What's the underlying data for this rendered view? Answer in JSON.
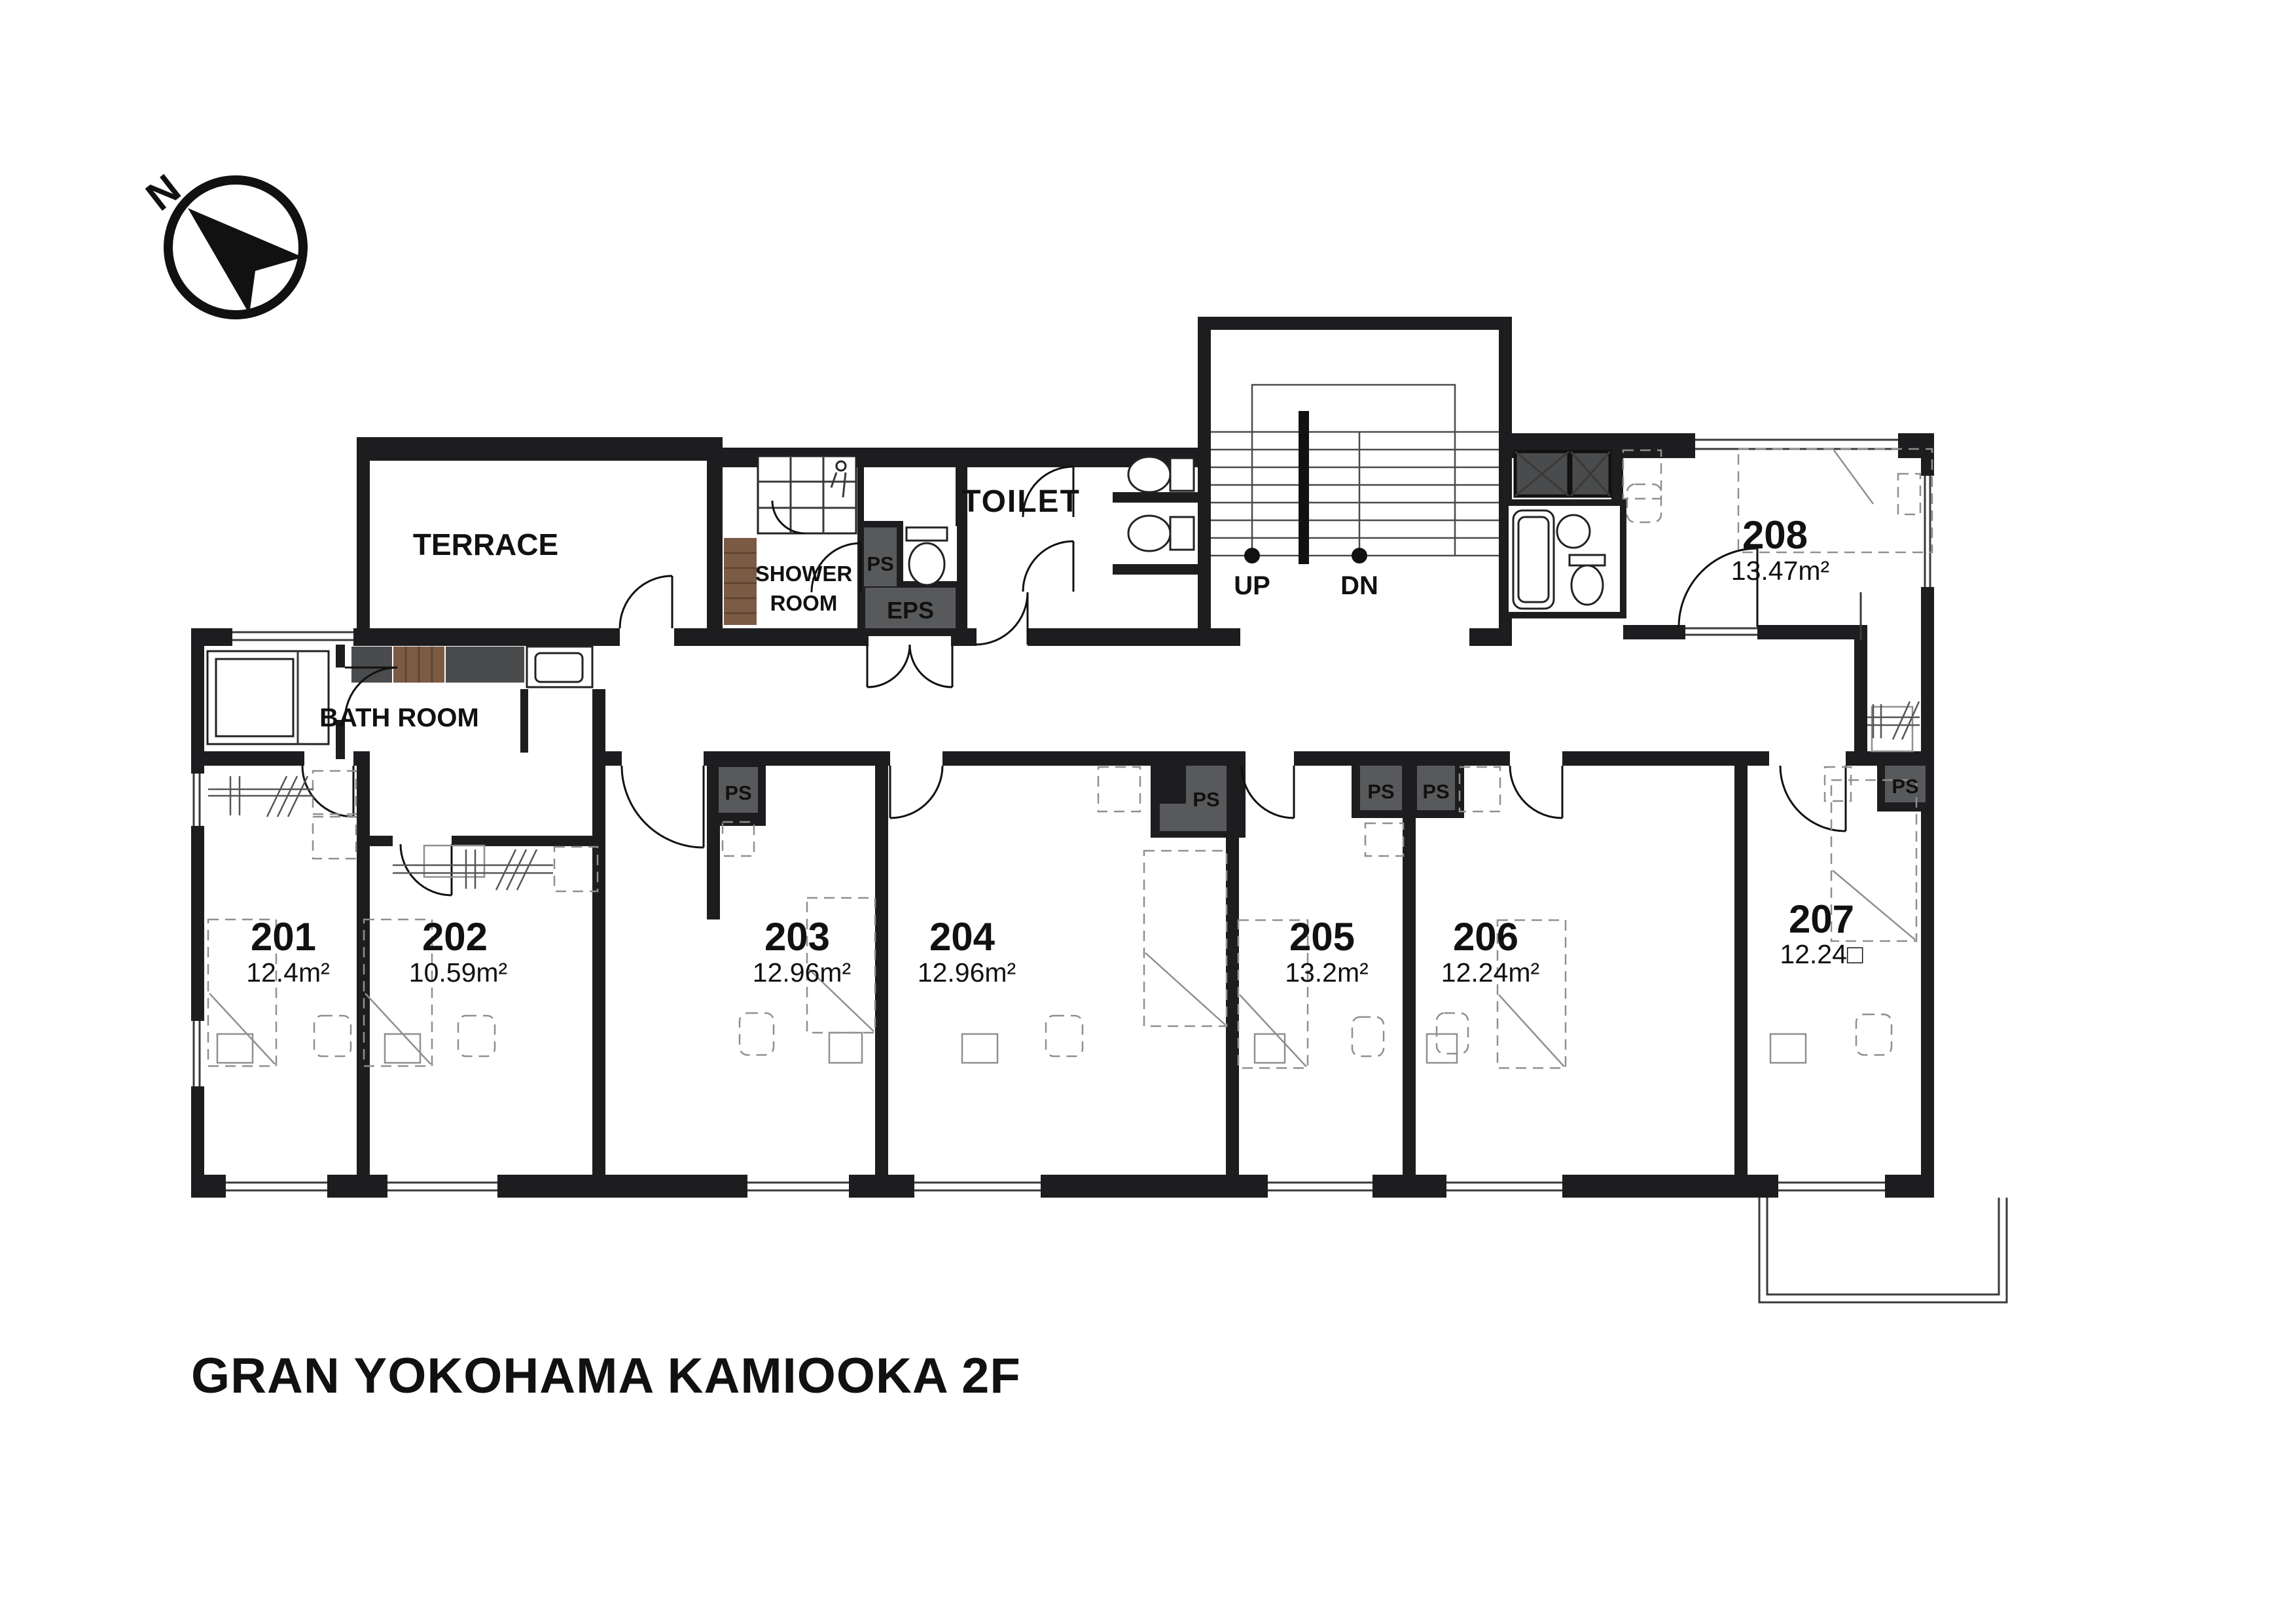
{
  "title": "GRAN YOKOHAMA KAMIOOKA 2F",
  "compass": {
    "north": "N"
  },
  "labels": {
    "terrace": "TERRACE",
    "bath_room": "BATH ROOM",
    "shower_line1": "SHOWER",
    "shower_line2": "ROOM",
    "toilet": "TOILET",
    "ps": "PS",
    "eps": "EPS",
    "up": "UP",
    "dn": "DN"
  },
  "rooms": [
    {
      "number": "201",
      "area": "12.4",
      "unit": "m²"
    },
    {
      "number": "202",
      "area": "10.59",
      "unit": "m²"
    },
    {
      "number": "203",
      "area": "12.96",
      "unit": "m²"
    },
    {
      "number": "204",
      "area": "12.96",
      "unit": "m²"
    },
    {
      "number": "205",
      "area": "13.2",
      "unit": "m²"
    },
    {
      "number": "206",
      "area": "12.24",
      "unit": "m²"
    },
    {
      "number": "207",
      "area": "12.24",
      "unit": "□"
    },
    {
      "number": "208",
      "area": "13.47",
      "unit": "m²"
    }
  ],
  "colors": {
    "wall": "#1d1d1f",
    "duct": "#58595b",
    "shaft": "#4a4b4d",
    "wood": "#7b5b43"
  }
}
